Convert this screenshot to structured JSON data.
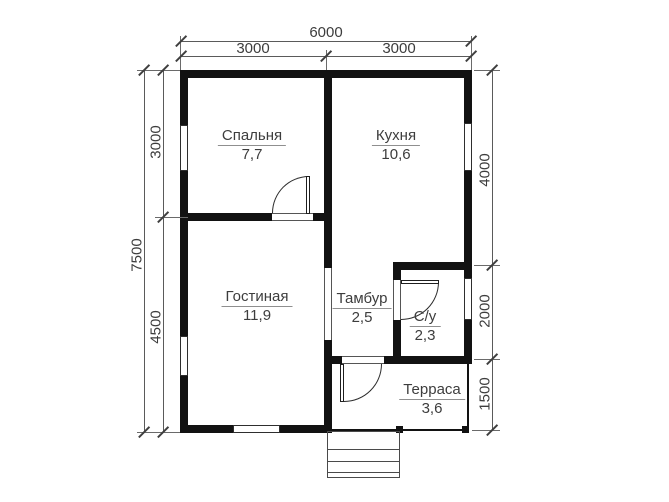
{
  "plan": {
    "title": "floor-plan",
    "rooms": [
      {
        "name": "Спальня",
        "area": "7,7"
      },
      {
        "name": "Кухня",
        "area": "10,6"
      },
      {
        "name": "Гостиная",
        "area": "11,9"
      },
      {
        "name": "Тамбур",
        "area": "2,5"
      },
      {
        "name": "С/у",
        "area": "2,3"
      },
      {
        "name": "Терраса",
        "area": "3,6"
      }
    ],
    "dimensions": {
      "top_total": "6000",
      "top_left": "3000",
      "top_right": "3000",
      "side_total": "7500",
      "side_upper": "3000",
      "side_lower": "4500",
      "right_upper": "4000",
      "right_middle": "2000",
      "right_lower": "1500"
    },
    "colors": {
      "wall": "#121212",
      "dimension_line": "#5a5a5a",
      "text": "#3d3d3d"
    }
  }
}
